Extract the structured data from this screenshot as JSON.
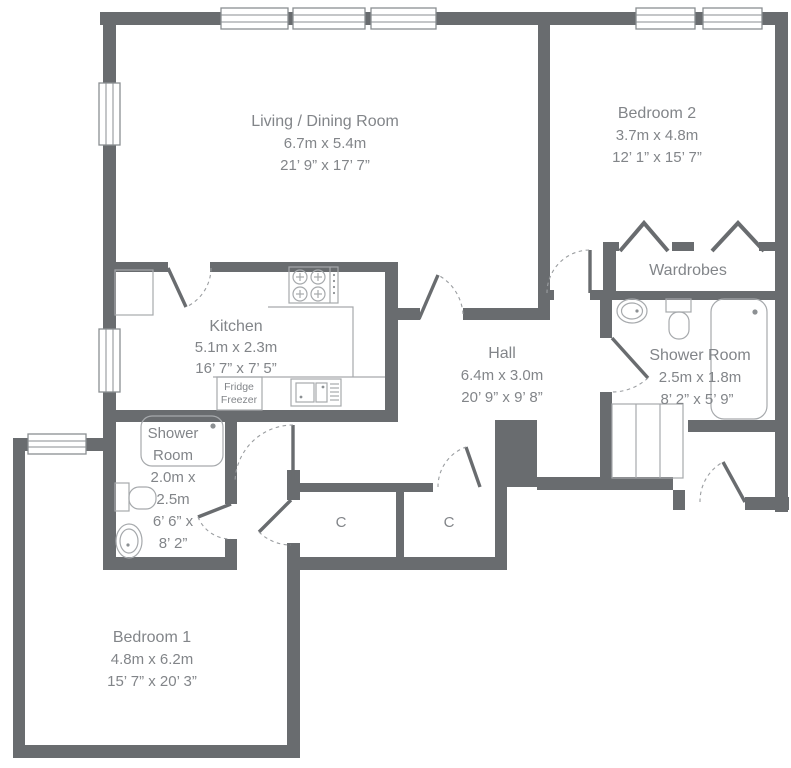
{
  "plan": {
    "wall_color": "#696c6f",
    "rooms": {
      "living": {
        "name": "Living / Dining Room",
        "metric": "6.7m x 5.4m",
        "imperial": "21’ 9” x 17’ 7”"
      },
      "bedroom2": {
        "name": "Bedroom 2",
        "metric": "3.7m x 4.8m",
        "imperial": "12’ 1” x 15’ 7”"
      },
      "kitchen": {
        "name": "Kitchen",
        "metric": "5.1m x 2.3m",
        "imperial": "16’ 7” x 7’ 5”"
      },
      "hall": {
        "name": "Hall",
        "metric": "6.4m x 3.0m",
        "imperial": "20’ 9” x 9’ 8”"
      },
      "shower_right": {
        "name": "Shower Room",
        "metric": "2.5m x 1.8m",
        "imperial": "8’ 2” x 5’ 9”"
      },
      "shower_left": {
        "lines": [
          "Shower",
          "Room",
          "2.0m x",
          "2.5m",
          "6’ 6” x",
          "8’ 2”"
        ]
      },
      "bedroom1": {
        "name": "Bedroom 1",
        "metric": "4.8m x 6.2m",
        "imperial": "15’ 7” x 20’ 3”"
      },
      "wardrobes": {
        "name": "Wardrobes"
      }
    },
    "closets": {
      "label_left": "C",
      "label_right": "C"
    },
    "appliances": {
      "fridge_line1": "Fridge",
      "fridge_line2": "Freezer"
    }
  }
}
